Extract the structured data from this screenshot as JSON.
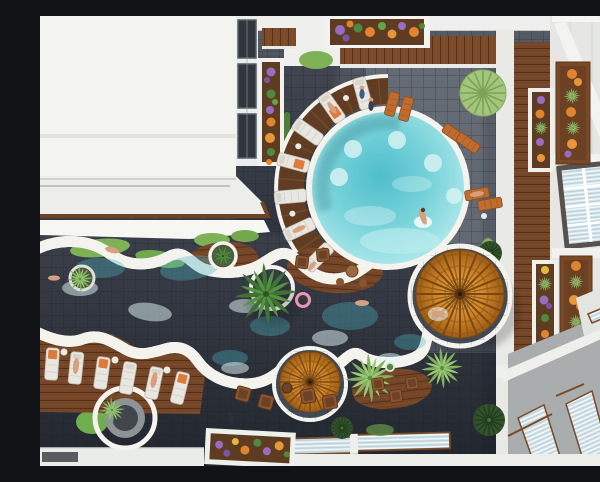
{
  "scene": {
    "title": "Aerial 3D render of a resort hotel courtyard pool area",
    "description": "Top-down aerial view of a hotel courtyard: a circular main pool with a curved wooden sun deck and radial white loungers, a free-form wavy lazy-river pool winding to the left, two woven rattan parasols, palm trees, white sun loungers with orange towels, wooden balcony planters full of orange and purple flowers, green hedges, glass skylights and stairways on the surrounding white rooftops.",
    "objects": {
      "pools": [
        "circular-main-pool",
        "lazy-river-pool"
      ],
      "parasols": 2,
      "palm_trees": 5,
      "round_shrubs": 4,
      "white_loungers_row": 6,
      "deck_arc_loungers": 7,
      "orange_loungers": 6,
      "balcony_planters": 8,
      "hedge_boxes": 3,
      "skylight_panels": 4,
      "people": 14
    },
    "palette": {
      "tile_dark": "#23272f",
      "tile_mid": "#50565f",
      "water_deep": "#4fbecb",
      "water_light": "#c7f0f0",
      "rim_white": "#f4f3ee",
      "wood_brown": "#7a4a2a",
      "deck_dark": "#603c22",
      "parasol_orange": "#cf8428",
      "towel_orange": "#de7b3a",
      "grass_green": "#7fb257",
      "bush_dark": "#32522c",
      "flower_orange": "#e2832f",
      "flower_purple": "#9a6cc0",
      "roof_white": "#f2f2ef"
    }
  }
}
